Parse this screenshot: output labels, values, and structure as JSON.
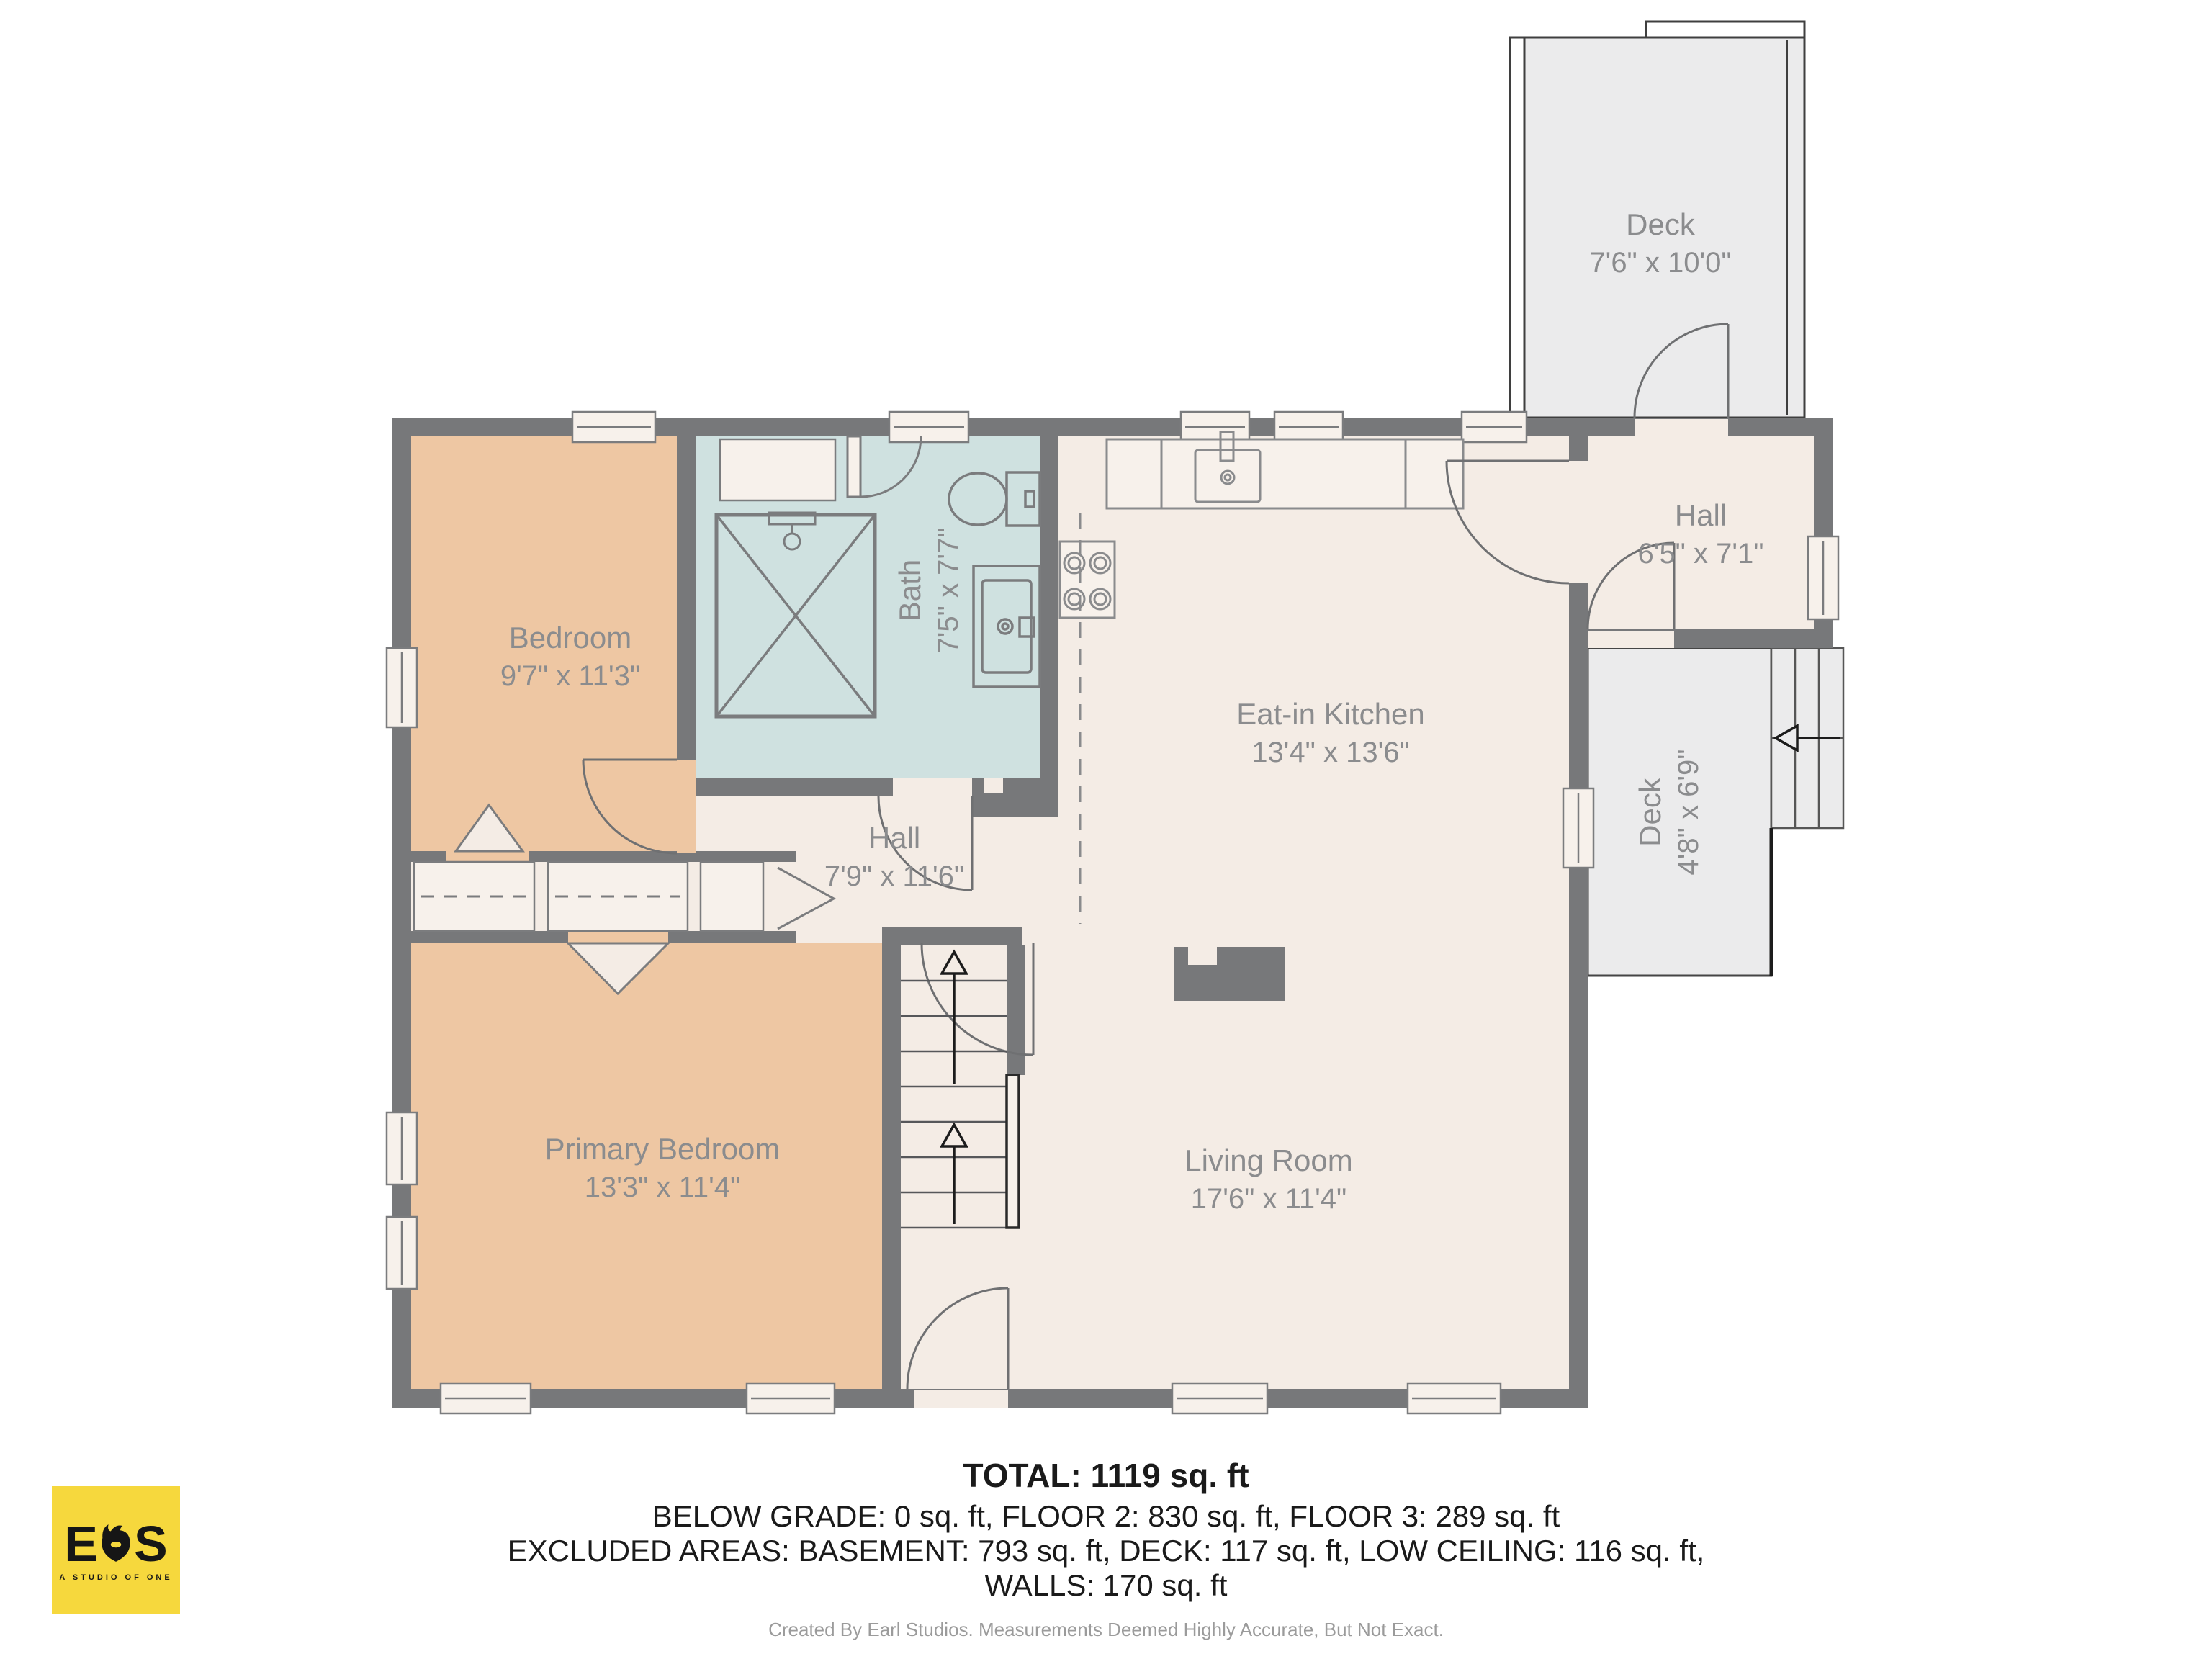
{
  "rooms": {
    "deck_top": {
      "name": "Deck",
      "dims": "7'6\" x 10'0\""
    },
    "bedroom": {
      "name": "Bedroom",
      "dims": "9'7\" x 11'3\""
    },
    "bath": {
      "name": "Bath",
      "dims": "7'5\" x 7'7\""
    },
    "kitchen": {
      "name": "Eat-in Kitchen",
      "dims": "13'4\" x 13'6\""
    },
    "hall_right": {
      "name": "Hall",
      "dims": "6'5\" x 7'1\""
    },
    "hall_center": {
      "name": "Hall",
      "dims": "7'9\" x 11'6\""
    },
    "deck_right": {
      "name": "Deck",
      "dims": "4'8\" x 6'9\""
    },
    "primary_bedroom": {
      "name": "Primary Bedroom",
      "dims": "13'3\" x 11'4\""
    },
    "living_room": {
      "name": "Living Room",
      "dims": "17'6\" x 11'4\""
    }
  },
  "summary": {
    "total": "TOTAL: 1119 sq. ft",
    "below_grade_line": "BELOW GRADE: 0 sq. ft, FLOOR 2: 830 sq. ft, FLOOR 3: 289 sq. ft",
    "excluded_line": "EXCLUDED AREAS: BASEMENT: 793 sq. ft, DECK: 117 sq. ft, LOW CEILING: 116 sq. ft,",
    "walls_line": "WALLS: 170 sq. ft",
    "disclaimer": "Created By Earl Studios. Measurements Deemed Highly Accurate, But Not Exact."
  },
  "logo": {
    "letter_left": "E",
    "letter_right": "S",
    "tagline": "A STUDIO OF ONE"
  },
  "colors": {
    "wall": "#77787a",
    "floor": "#f4ece5",
    "bedroom_fill": "#eec7a3",
    "bath_fill": "#cfe1e0",
    "deck_fill": "#ebebec",
    "window_fill": "#f7f1eb",
    "label_text": "#8b8c8e",
    "logo_yellow": "#f6d83d"
  }
}
